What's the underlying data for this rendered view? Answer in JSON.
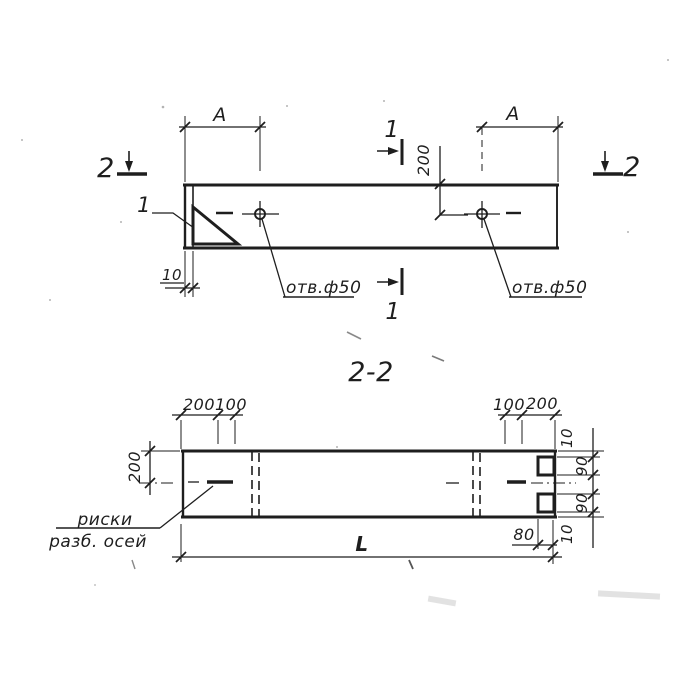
{
  "plan_view": {
    "dim_a_left": "A",
    "dim_a_right": "A",
    "dim_200": "200",
    "dim_10": "10",
    "detail_callout": "1",
    "section2_left": "2",
    "section2_right": "2",
    "section1_top": "1",
    "section1_bottom": "1",
    "hole_left_label": "отв.ф50",
    "hole_right_label": "отв.ф50"
  },
  "section_view": {
    "title": "2-2",
    "top_dims_left": {
      "d200": "200",
      "d100": "100"
    },
    "top_dims_right": {
      "d100": "100",
      "d200": "200"
    },
    "left_dim_200": "200",
    "right_dims": {
      "d10_top": "10",
      "d90_top": "90",
      "d90_bottom": "90",
      "d10_bottom": "10"
    },
    "dim_80": "80",
    "dim_length": "L",
    "axis_note": {
      "line1": "риски",
      "line2": "разб. осей"
    }
  },
  "colors": {
    "ink": "#1e1e1e",
    "paper": "#ffffff"
  }
}
